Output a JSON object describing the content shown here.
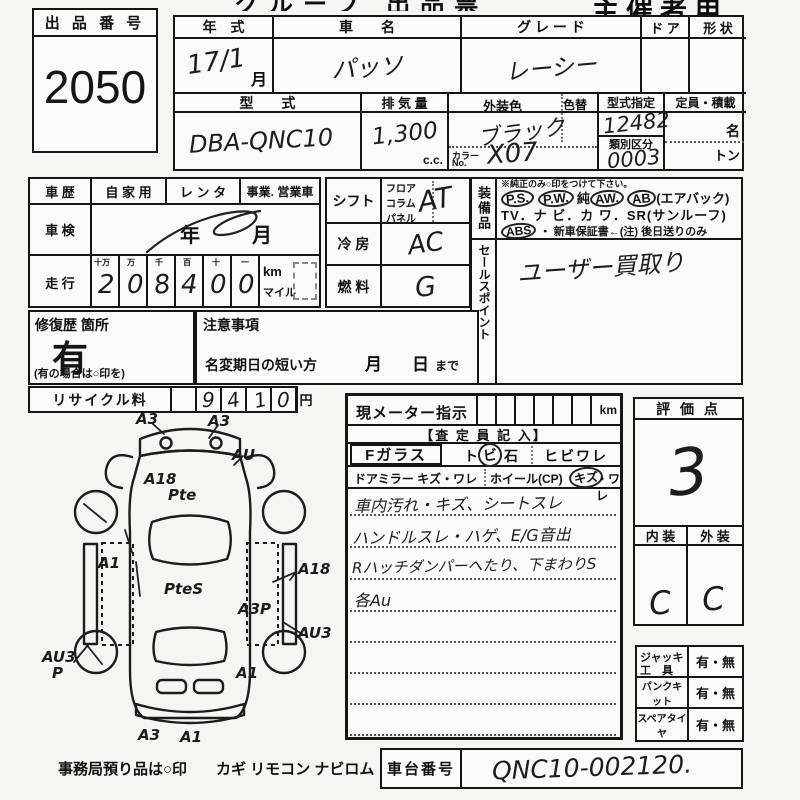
{
  "header": {
    "form_title": "グループ 出品票",
    "organizer": "主催者用"
  },
  "lot": {
    "label": "出 品 番 号",
    "number": "2050"
  },
  "vehicle": {
    "year_label": "年　式",
    "year_value": "17/1",
    "month_suffix": "月",
    "name_label": "車　　名",
    "name_value": "パッソ",
    "grade_label": "グ レ ー ド",
    "grade_value": "レーシー",
    "door_label": "ド ア",
    "shape_label": "形 状",
    "model_label": "型　　式",
    "model_value": "DBA-QNC10",
    "displacement_label": "排 気 量",
    "displacement_value": "1,300",
    "cc_suffix": "c.c.",
    "color_label": "外装色",
    "color_change_label": "色替",
    "color_value": "ブラック",
    "color_no_label1": "カラー",
    "color_no_label2": "No.",
    "color_no_value": "X07",
    "type_designation_label": "型式指定",
    "type_designation_value": "12482",
    "class_label": "類別区分",
    "class_value": "0003",
    "capacity_label": "定員・積載",
    "persons_suffix": "名",
    "tons_suffix": "トン"
  },
  "history": {
    "label": "車 歴",
    "opt1": "自 家 用",
    "opt2": "レ ン タ",
    "opt3": "事業. 営業車"
  },
  "inspection": {
    "label": "車 検",
    "year_suffix": "年",
    "month_suffix": "月"
  },
  "mileage": {
    "label": "走 行",
    "digit_headers": [
      "十万",
      "万",
      "千",
      "百",
      "十",
      "一"
    ],
    "digits": [
      "2",
      "0",
      "8",
      "4",
      "0",
      "0"
    ],
    "unit_km": "km",
    "unit_mile": "マイル"
  },
  "shift": {
    "label": "シフト",
    "opt1": "フロア",
    "opt2": "コラム",
    "opt3": "パネル",
    "value": "AT"
  },
  "aircon": {
    "label": "冷 房",
    "value": "AC"
  },
  "fuel": {
    "label": "燃 料",
    "value": "G"
  },
  "equipment": {
    "label": "装備品",
    "note": "※純正のみ○印をつけて下さい。",
    "ps": "P.S.",
    "pw": "P.W.",
    "jun": "純",
    "aw": "AW.",
    "ab": "AB",
    "airbag": "(エアバック)",
    "line2": "TV．ナ ビ．カ ワ．SR(サンルーフ)",
    "abs": "ABS",
    "warranty": "・ 新車保証書←(注) 後日送りのみ"
  },
  "sales_point": {
    "label": "セールスポイント",
    "value": "ユーザー買取り"
  },
  "repair": {
    "label": "修復歴 箇所",
    "value": "有",
    "note": "(有の場合は○印を)"
  },
  "caution": {
    "label": "注意事項",
    "line": "名変期日の短い方",
    "month": "月",
    "day": "日",
    "until": "まで"
  },
  "recycle": {
    "label": "リサイクル料",
    "digits": [
      "",
      "9",
      "4",
      "1",
      "0"
    ],
    "unit": "円"
  },
  "meter": {
    "label": "現メーター指示",
    "unit": "km",
    "inspector_header": "【査 定 員 記 入】",
    "fglass_label": "Fガラス",
    "fg1": "ト",
    "fg2": "ビ",
    "fg3": "石",
    "fglass_opt2": "ヒビワレ",
    "mirror_label": "ドアミラー キズ・ワレ",
    "wheel_label": "ホイール(CP)",
    "wheel_kizu": "キズ",
    "wheel_ware": "・ワレ",
    "notes": [
      "車内汚れ・キズ、シートスレ",
      "ハンドルスレ・ハゲ、E/G音出",
      "Rハッチダンパーへたり、下まわりS",
      "各Au"
    ]
  },
  "score": {
    "label": "評 価 点",
    "value": "3",
    "interior_label": "内 装",
    "exterior_label": "外 装",
    "interior_value": "C",
    "exterior_value": "C"
  },
  "accessories": {
    "rows": [
      {
        "label1": "ジャッキ",
        "label2": "工　具",
        "value": "有・無"
      },
      {
        "label1": "パンクキット",
        "label2": "",
        "value": "有・無"
      },
      {
        "label1": "スペアタイヤ",
        "label2": "",
        "value": "有・無"
      }
    ]
  },
  "chassis": {
    "label": "車台番号",
    "value": "QNC10-002120."
  },
  "footer": {
    "note": "事務局預り品は○印",
    "items": "カギ  リモコン  ナビロム"
  },
  "diagram": {
    "annotations": [
      "A3",
      "A3",
      "A18",
      "AU",
      "Pte",
      "A1",
      "PteS",
      "A18",
      "A3P",
      "AU3",
      "AU3",
      "P",
      "A1",
      "A3",
      "A1"
    ]
  },
  "colors": {
    "ink": "#151515",
    "paper": "#f6f5f2"
  }
}
